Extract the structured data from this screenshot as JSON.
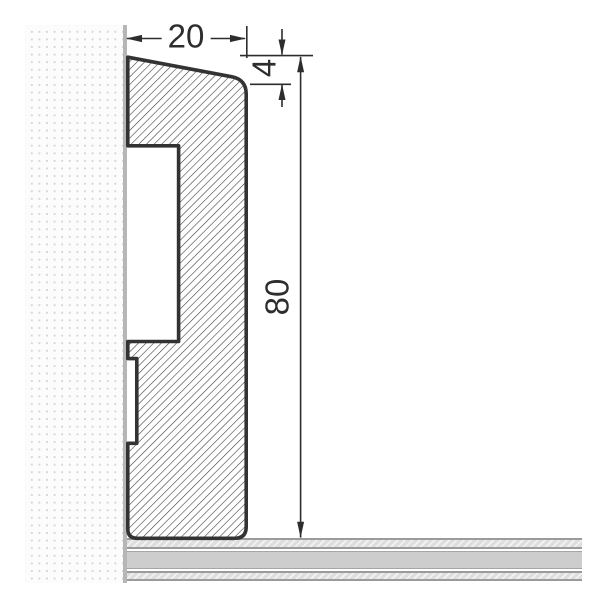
{
  "drawing": {
    "type": "technical-cross-section",
    "subject": "skirting-board-profile-on-wall-and-floor",
    "dimensions": {
      "width_label": "20",
      "bevel_label": "4",
      "height_label": "80"
    },
    "colors": {
      "outline": "#333333",
      "dimension_lines": "#2d2d2d",
      "wall_surface": "#b6b6b6",
      "wall_dots": "#d6d6d6",
      "floor_core": "#cdcdcd",
      "floor_border": "#9b9b9b",
      "background": "#ffffff"
    }
  }
}
